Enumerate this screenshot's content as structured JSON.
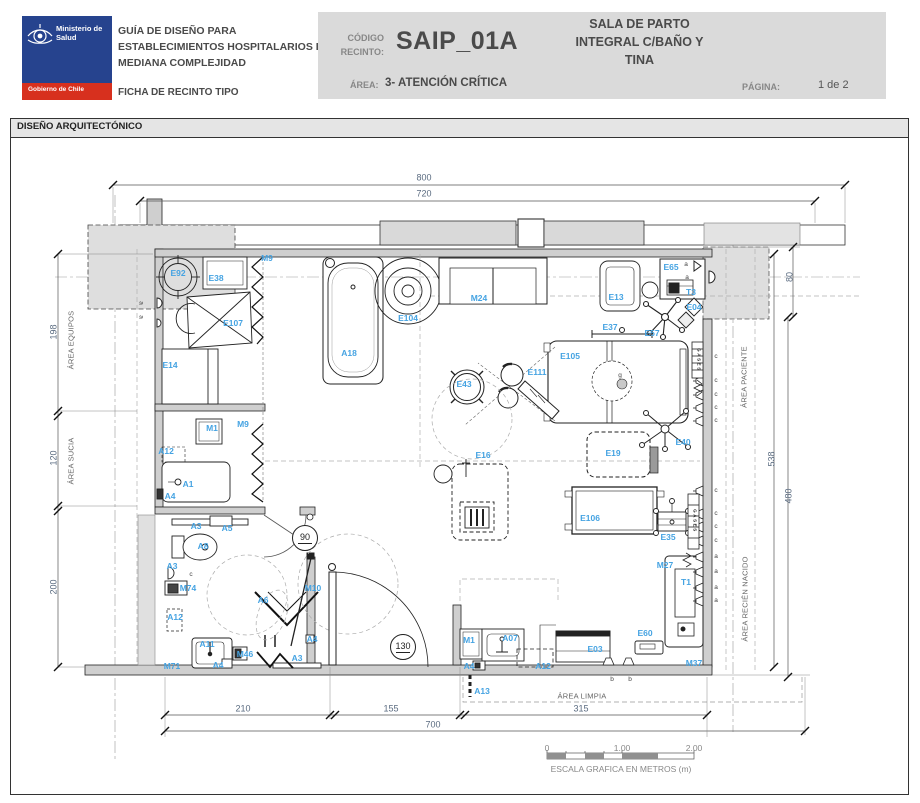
{
  "header": {
    "logo": {
      "ministry": "Ministerio de Salud",
      "government": "Gobierno de Chile"
    },
    "doc_title_lines": [
      "GUÍA DE DISEÑO PARA",
      "ESTABLECIMIENTOS HOSPITALARIOS DE",
      "MEDIANA COMPLEJIDAD"
    ],
    "doc_subtitle": "FICHA DE RECINTO TIPO",
    "code_label_1": "CÓDIGO",
    "code_label_2": "RECINTO:",
    "code_value": "SAIP_01A",
    "area_label": "ÁREA:",
    "area_value": "3- ATENCIÓN CRÍTICA",
    "room_name_lines": [
      "SALA DE PARTO",
      "INTEGRAL C/BAÑO  Y",
      "TINA"
    ],
    "page_label": "PÁGINA:",
    "page_value": "1 de 2"
  },
  "section_title": "DISEÑO ARQUITECTÓNICO",
  "plan": {
    "scale_caption": "ESCALA GRAFICA EN METROS (m)",
    "labels": [
      {
        "t": "M9",
        "x": 257,
        "y": 121,
        "c": "code"
      },
      {
        "t": "E92",
        "x": 168,
        "y": 136,
        "c": "code"
      },
      {
        "t": "E38",
        "x": 206,
        "y": 141,
        "c": "code"
      },
      {
        "t": "E107",
        "x": 223,
        "y": 186,
        "c": "code"
      },
      {
        "t": "E14",
        "x": 160,
        "y": 228,
        "c": "code"
      },
      {
        "t": "A18",
        "x": 339,
        "y": 216,
        "c": "code"
      },
      {
        "t": "E104",
        "x": 398,
        "y": 181,
        "c": "code"
      },
      {
        "t": "M24",
        "x": 469,
        "y": 161,
        "c": "code"
      },
      {
        "t": "E13",
        "x": 606,
        "y": 160,
        "c": "code"
      },
      {
        "t": "E65",
        "x": 661,
        "y": 130,
        "c": "code"
      },
      {
        "t": "T3",
        "x": 681,
        "y": 155,
        "c": "code"
      },
      {
        "t": "E04",
        "x": 684,
        "y": 170,
        "c": "code"
      },
      {
        "t": "E57",
        "x": 642,
        "y": 196,
        "c": "code"
      },
      {
        "t": "E37",
        "x": 600,
        "y": 190,
        "c": "code"
      },
      {
        "t": "E105",
        "x": 560,
        "y": 219,
        "c": "code"
      },
      {
        "t": "E111",
        "x": 527,
        "y": 235,
        "c": "code"
      },
      {
        "t": "E43",
        "x": 454,
        "y": 247,
        "c": "code"
      },
      {
        "t": "E16",
        "x": 473,
        "y": 318,
        "c": "code"
      },
      {
        "t": "E19",
        "x": 603,
        "y": 316,
        "c": "code"
      },
      {
        "t": "E40",
        "x": 673,
        "y": 305,
        "c": "code"
      },
      {
        "t": "E106",
        "x": 580,
        "y": 381,
        "c": "code"
      },
      {
        "t": "E35",
        "x": 658,
        "y": 400,
        "c": "code"
      },
      {
        "t": "M27",
        "x": 655,
        "y": 428,
        "c": "code"
      },
      {
        "t": "T1",
        "x": 676,
        "y": 445,
        "c": "code"
      },
      {
        "t": "E60",
        "x": 635,
        "y": 496,
        "c": "code"
      },
      {
        "t": "E03",
        "x": 585,
        "y": 512,
        "c": "code"
      },
      {
        "t": "M37",
        "x": 684,
        "y": 526,
        "c": "code"
      },
      {
        "t": "M1",
        "x": 459,
        "y": 503,
        "c": "code"
      },
      {
        "t": "A07",
        "x": 500,
        "y": 501,
        "c": "code"
      },
      {
        "t": "A4",
        "x": 459,
        "y": 529,
        "c": "code"
      },
      {
        "t": "A12",
        "x": 533,
        "y": 529,
        "c": "code"
      },
      {
        "t": "A13",
        "x": 472,
        "y": 554,
        "c": "code"
      },
      {
        "t": "M1",
        "x": 202,
        "y": 291,
        "c": "code"
      },
      {
        "t": "M9",
        "x": 233,
        "y": 287,
        "c": "code"
      },
      {
        "t": "A12",
        "x": 156,
        "y": 314,
        "c": "code"
      },
      {
        "t": "A1",
        "x": 178,
        "y": 347,
        "c": "code"
      },
      {
        "t": "A4",
        "x": 160,
        "y": 359,
        "c": "code"
      },
      {
        "t": "A3",
        "x": 186,
        "y": 389,
        "c": "code"
      },
      {
        "t": "A5",
        "x": 217,
        "y": 391,
        "c": "code"
      },
      {
        "t": "A8",
        "x": 193,
        "y": 409,
        "c": "code"
      },
      {
        "t": "A3",
        "x": 162,
        "y": 429,
        "c": "code"
      },
      {
        "t": "M74",
        "x": 178,
        "y": 451,
        "c": "code"
      },
      {
        "t": "A12",
        "x": 165,
        "y": 480,
        "c": "code"
      },
      {
        "t": "A11",
        "x": 197,
        "y": 507,
        "c": "code"
      },
      {
        "t": "A4",
        "x": 208,
        "y": 528,
        "c": "code"
      },
      {
        "t": "M71",
        "x": 162,
        "y": 529,
        "c": "code"
      },
      {
        "t": "M46",
        "x": 235,
        "y": 517,
        "c": "code"
      },
      {
        "t": "A3",
        "x": 287,
        "y": 521,
        "c": "code"
      },
      {
        "t": "A4",
        "x": 302,
        "y": 502,
        "c": "code"
      },
      {
        "t": "A6",
        "x": 253,
        "y": 463,
        "c": "code"
      },
      {
        "t": "M10",
        "x": 303,
        "y": 451,
        "c": "code"
      },
      {
        "t": "800",
        "x": 414,
        "y": 41,
        "c": "dim"
      },
      {
        "t": "720",
        "x": 414,
        "y": 57,
        "c": "dim"
      },
      {
        "t": "198",
        "x": 44,
        "y": 195,
        "c": "dim",
        "r": 1
      },
      {
        "t": "120",
        "x": 44,
        "y": 321,
        "c": "dim",
        "r": 1
      },
      {
        "t": "200",
        "x": 44,
        "y": 450,
        "c": "dim",
        "r": 1
      },
      {
        "t": "80",
        "x": 780,
        "y": 140,
        "c": "dim",
        "r": 1
      },
      {
        "t": "538",
        "x": 762,
        "y": 322,
        "c": "dim",
        "r": 1
      },
      {
        "t": "480",
        "x": 779,
        "y": 359,
        "c": "dim",
        "r": 1
      },
      {
        "t": "210",
        "x": 233,
        "y": 572,
        "c": "dim"
      },
      {
        "t": "155",
        "x": 381,
        "y": 572,
        "c": "dim"
      },
      {
        "t": "315",
        "x": 571,
        "y": 572,
        "c": "dim"
      },
      {
        "t": "700",
        "x": 423,
        "y": 588,
        "c": "dim"
      },
      {
        "t": "ÁREA EQUIPOS",
        "x": 61,
        "y": 203,
        "c": "area",
        "r": 1
      },
      {
        "t": "ÁREA SUCIA",
        "x": 61,
        "y": 324,
        "c": "area",
        "r": 1
      },
      {
        "t": "ÁREA PACIENTE",
        "x": 734,
        "y": 240,
        "c": "area",
        "r": 1
      },
      {
        "t": "ÁREA RECIÉN NACIDO",
        "x": 735,
        "y": 462,
        "c": "area",
        "r": 1
      },
      {
        "t": "ÁREA LIMPIA",
        "x": 572,
        "y": 559,
        "c": "area"
      },
      {
        "t": "c",
        "x": 706,
        "y": 220,
        "c": "letter"
      },
      {
        "t": "c",
        "x": 706,
        "y": 244,
        "c": "letter"
      },
      {
        "t": "c",
        "x": 706,
        "y": 258,
        "c": "letter"
      },
      {
        "t": "c",
        "x": 706,
        "y": 271,
        "c": "letter"
      },
      {
        "t": "c",
        "x": 706,
        "y": 284,
        "c": "letter"
      },
      {
        "t": "c",
        "x": 706,
        "y": 354,
        "c": "letter"
      },
      {
        "t": "c",
        "x": 706,
        "y": 377,
        "c": "letter"
      },
      {
        "t": "c",
        "x": 706,
        "y": 390,
        "c": "letter"
      },
      {
        "t": "c",
        "x": 706,
        "y": 404,
        "c": "letter"
      },
      {
        "t": "a",
        "x": 706,
        "y": 420,
        "c": "letter"
      },
      {
        "t": "a",
        "x": 706,
        "y": 435,
        "c": "letter"
      },
      {
        "t": "a",
        "x": 706,
        "y": 451,
        "c": "letter"
      },
      {
        "t": "a",
        "x": 706,
        "y": 464,
        "c": "letter"
      },
      {
        "t": "b",
        "x": 602,
        "y": 543,
        "c": "letter"
      },
      {
        "t": "b",
        "x": 620,
        "y": 543,
        "c": "letter"
      },
      {
        "t": "c",
        "x": 181,
        "y": 438,
        "c": "letter"
      },
      {
        "t": "a",
        "x": 130,
        "y": 166,
        "c": "letter",
        "r": 2
      },
      {
        "t": "a",
        "x": 130,
        "y": 180,
        "c": "letter",
        "r": 2
      },
      {
        "t": "a",
        "x": 676,
        "y": 128,
        "c": "letter"
      },
      {
        "t": "a",
        "x": 677,
        "y": 141,
        "c": "letter"
      },
      {
        "t": "g",
        "x": 610,
        "y": 239,
        "c": "letter"
      },
      {
        "t": "GASES",
        "x": 688,
        "y": 223,
        "c": "gases",
        "r": 2
      },
      {
        "t": "GASES",
        "x": 684,
        "y": 384,
        "c": "gases",
        "r": 2
      },
      {
        "t": "0",
        "x": 537,
        "y": 611,
        "c": "scale"
      },
      {
        "t": "1.00",
        "x": 612,
        "y": 611,
        "c": "scale"
      },
      {
        "t": "2.00",
        "x": 684,
        "y": 611,
        "c": "scale"
      },
      {
        "t": "ESCALA GRAFICA EN METROS (m)",
        "x": 611,
        "y": 632,
        "c": "scale"
      },
      {
        "t": "90",
        "x": 295,
        "y": 401,
        "c": "tag"
      },
      {
        "t": "130",
        "x": 393,
        "y": 510,
        "c": "tag"
      }
    ]
  }
}
